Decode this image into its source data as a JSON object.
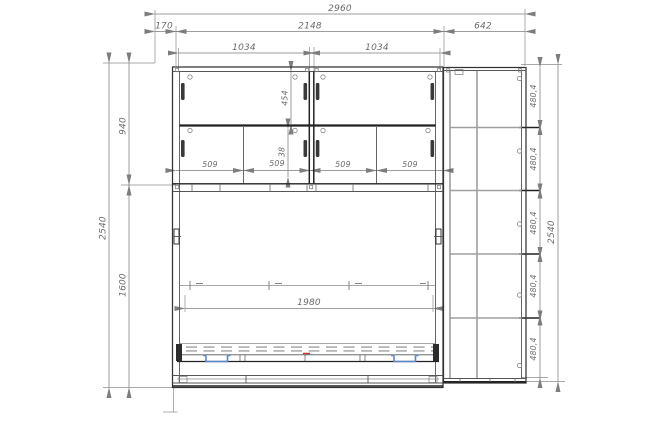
{
  "drawing": {
    "description": "furniture-technical-drawing",
    "dims": {
      "top": {
        "overall": "2960",
        "offset": "170",
        "body": "2148",
        "side": "642",
        "shelf_l": "1034",
        "shelf_r": "1034"
      },
      "left": {
        "total": "2540",
        "upper": "940",
        "lower": "1600"
      },
      "inner": {
        "top_row": "454",
        "small": "38",
        "c": [
          "509",
          "509",
          "509",
          "509"
        ],
        "bed": "1980"
      },
      "right": {
        "s": [
          "480,4",
          "480,4",
          "480,4",
          "480,4",
          "480,4"
        ],
        "total": "2540"
      }
    },
    "colors": {
      "line": "#333333",
      "dim": "#7d7d7d",
      "bracket_blue": "#5c86cc",
      "mark_red": "#cc3333",
      "background": "#ffffff"
    }
  }
}
